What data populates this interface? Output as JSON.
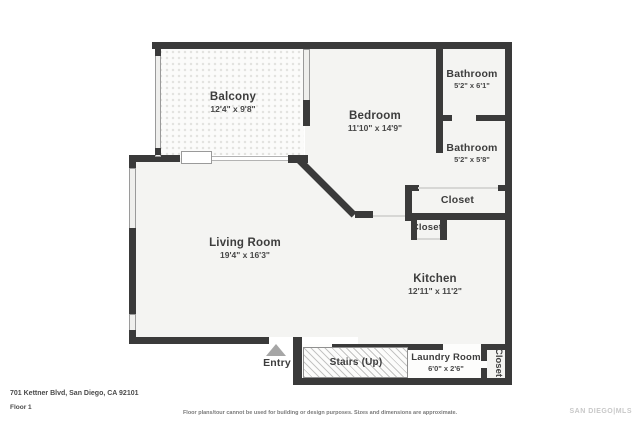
{
  "floorplan": {
    "rooms": {
      "balcony": {
        "name": "Balcony",
        "dims": "12'4\" x 9'8\""
      },
      "bedroom": {
        "name": "Bedroom",
        "dims": "11'10\" x 14'9\""
      },
      "bathroom1": {
        "name": "Bathroom",
        "dims": "5'2\" x 6'1\""
      },
      "bathroom2": {
        "name": "Bathroom",
        "dims": "5'2\" x 5'8\""
      },
      "closet1": {
        "name": "Closet"
      },
      "closet2": {
        "name": "Closet"
      },
      "living": {
        "name": "Living Room",
        "dims": "19'4\" x 16'3\""
      },
      "kitchen": {
        "name": "Kitchen",
        "dims": "12'11\" x 11'2\""
      },
      "stairs": {
        "name": "Stairs (Up)"
      },
      "laundry": {
        "name": "Laundry Room",
        "dims": "6'0\" x 2'6\""
      },
      "closet3": {
        "name": "Closet"
      },
      "entry": {
        "name": "Entry"
      }
    },
    "colors": {
      "wall": "#3a3a3a",
      "floor": "#f4f4f2",
      "entry_arrow": "#a6a6a6"
    }
  },
  "footer": {
    "address": "701 Kettner Blvd, San Diego, CA 92101",
    "floor_label": "Floor 1",
    "disclaimer": "Floor plans/tour cannot be used for building or design purposes. Sizes and dimensions are approximate.",
    "watermark": "SAN DIEGO|MLS"
  }
}
